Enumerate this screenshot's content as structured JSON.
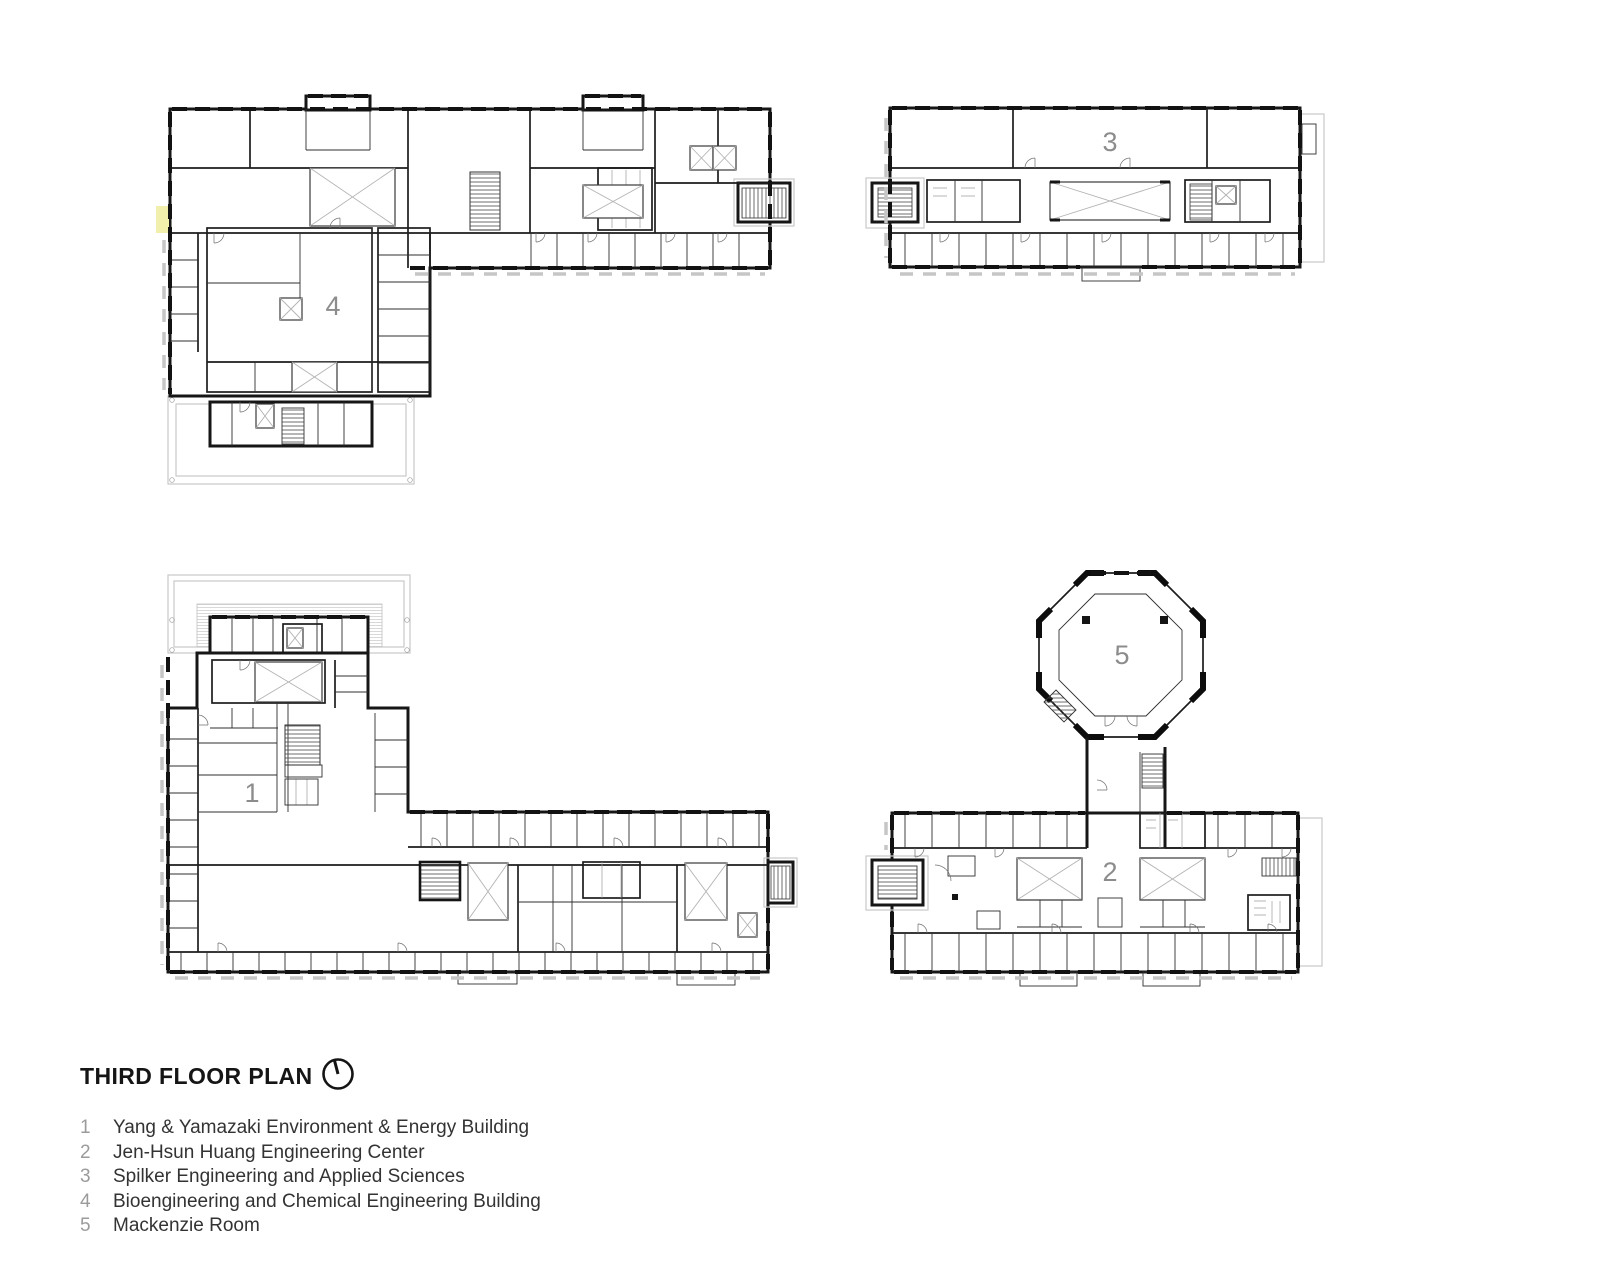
{
  "sheet": {
    "title": "THIRD FLOOR PLAN"
  },
  "icons": {
    "north": "north-arrow"
  },
  "legend": {
    "items": [
      {
        "num": "1",
        "name": "Yang & Yamazaki Environment & Energy Building"
      },
      {
        "num": "2",
        "name": "Jen-Hsun Huang Engineering Center"
      },
      {
        "num": "3",
        "name": "Spilker Engineering and Applied Sciences"
      },
      {
        "num": "4",
        "name": "Bioengineering and Chemical Engineering Building"
      },
      {
        "num": "5",
        "name": "Mackenzie Room"
      }
    ]
  },
  "plans": {
    "p1": {
      "label": "1"
    },
    "p2": {
      "label": "2"
    },
    "p3": {
      "label": "3"
    },
    "p4": {
      "label": "4"
    },
    "p5": {
      "label": "5"
    }
  },
  "colors": {
    "ink": "#161616",
    "terrace": "#c9c9c9",
    "label": "#8c8c8c",
    "legend-num": "#9b9b9b",
    "legend-text": "#333333",
    "hl": "#f2efad",
    "bg": "#ffffff"
  }
}
